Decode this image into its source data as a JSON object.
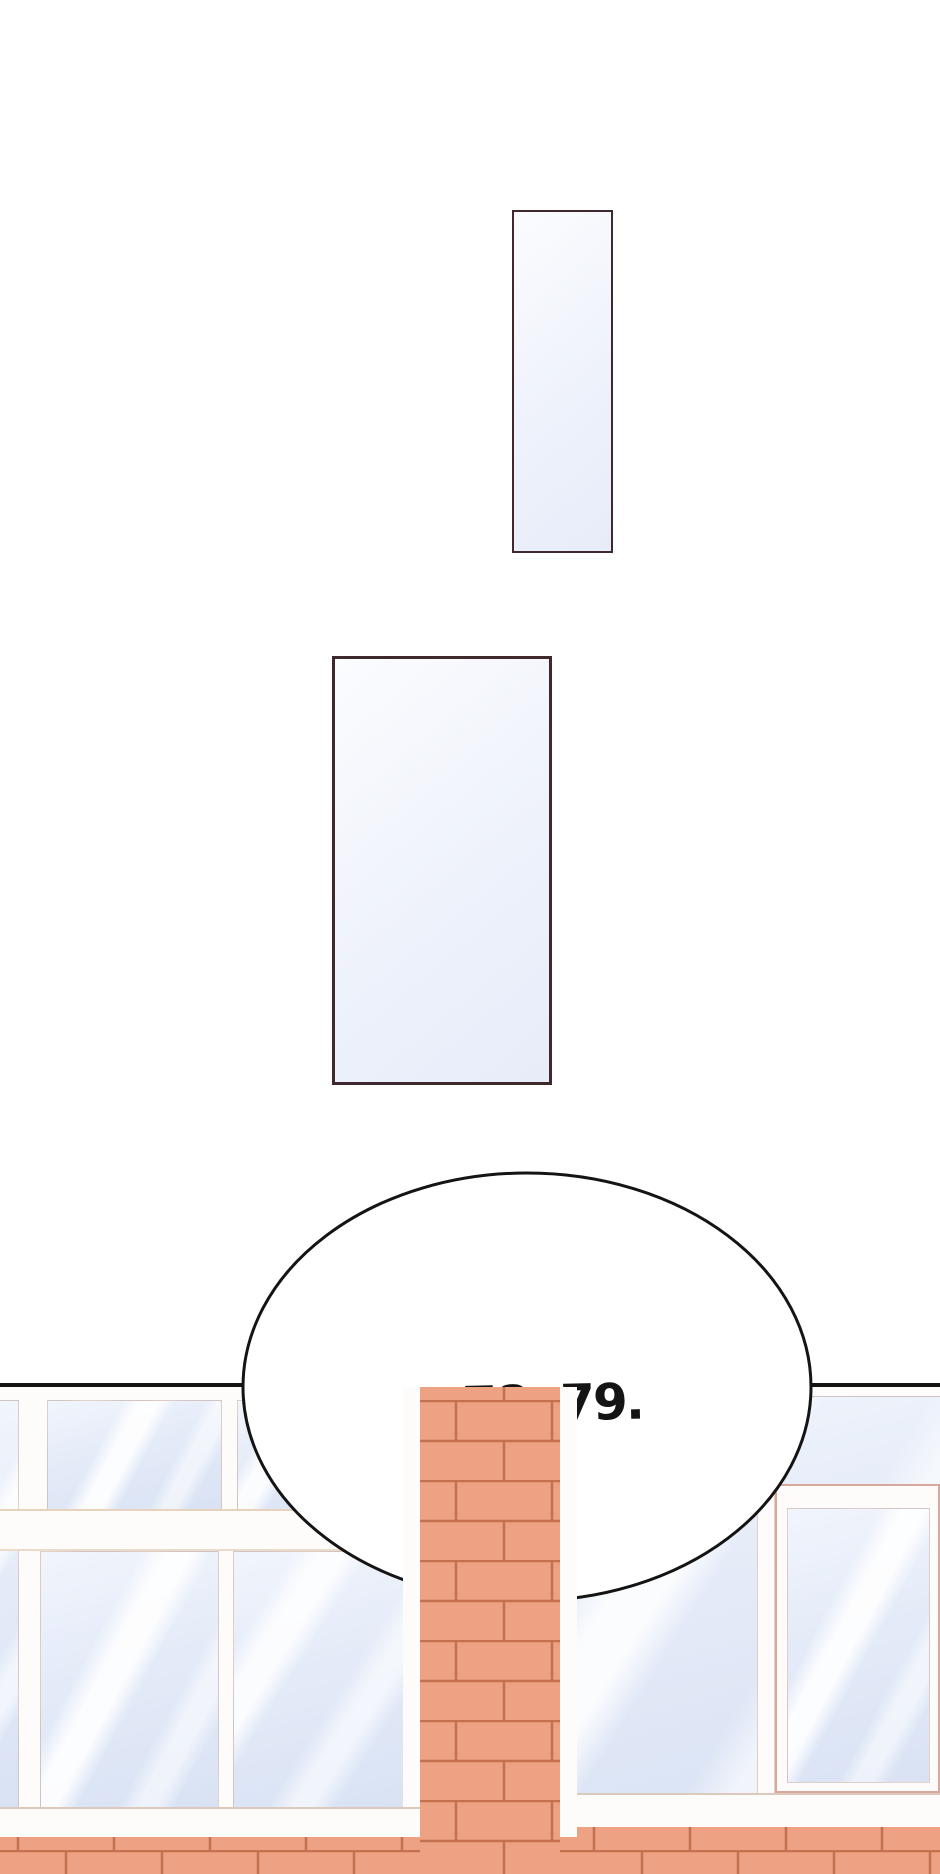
{
  "speech_bubble": {
    "text": "...78, 79."
  },
  "theme": {
    "ink": "#141414",
    "panel-border": "#40292d",
    "panel-fill-light": "#fbfcfe",
    "panel-fill-dark": "#e7ecf9",
    "frame": "#fdfcfa",
    "glass-light": "#f1f5fc",
    "glass-dark": "#d9e2f4",
    "brick": "#eda283",
    "mortar": "#c4714f",
    "trim-pink": "#d8a89e"
  }
}
